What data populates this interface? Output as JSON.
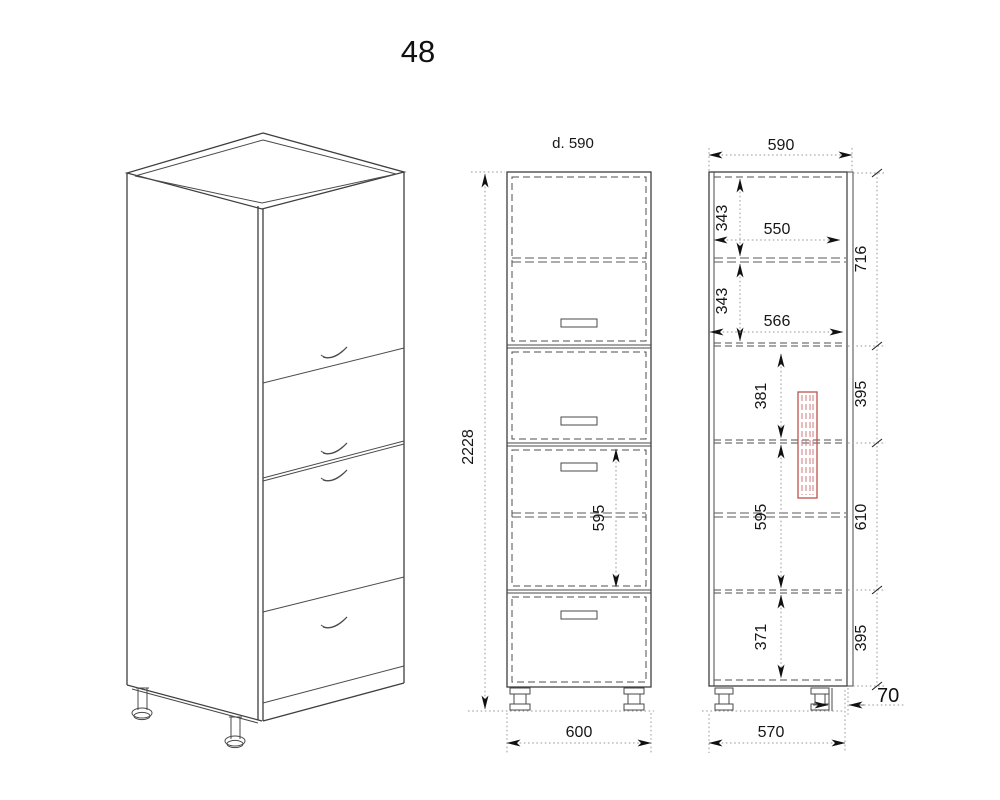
{
  "page": {
    "title": "48"
  },
  "colors": {
    "background": "#ffffff",
    "line": "#3e3e3e",
    "dimension_line": "#9a9a9a",
    "text": "#161616",
    "highlight_red": "#c0504d"
  },
  "front_view": {
    "depth_note": "d. 590",
    "overall_height": "2228",
    "middle_drawer_height": "595",
    "overall_width": "600"
  },
  "side_view": {
    "overall_depth": "590",
    "top_shelf_gap": "343",
    "inner_depth_top": "550",
    "second_shelf_gap": "343",
    "inner_depth_mid": "566",
    "rail_gap": "381",
    "middle_drawer_height": "595",
    "bottom_gap": "371",
    "front_heights": [
      "716",
      "395",
      "610",
      "395"
    ],
    "plinth_recess": "70",
    "base_depth": "570"
  }
}
